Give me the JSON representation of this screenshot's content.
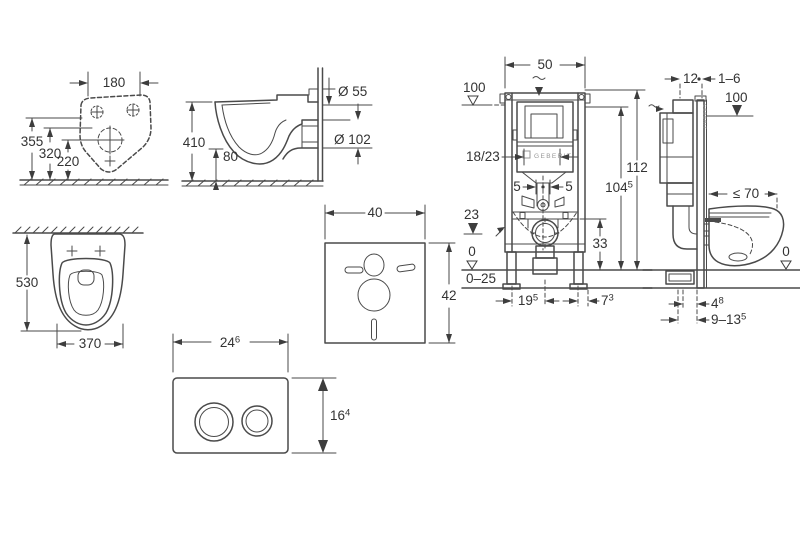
{
  "sheet": {
    "background": "#ffffff",
    "line_color": "#4a4a4a",
    "text_color": "#333333"
  },
  "views": {
    "toilet_rear": {
      "dim_width": "180",
      "dim_h1": "355",
      "dim_h2": "320",
      "dim_h3": "220"
    },
    "toilet_side": {
      "dim_height": "410",
      "dim_outlet_floor": "80",
      "dim_inlet": "Ø 55",
      "dim_outlet": "Ø 102"
    },
    "toilet_top": {
      "dim_depth": "530",
      "dim_width": "370"
    },
    "insulation_pad": {
      "dim_width": "40",
      "dim_height": "42"
    },
    "flush_plate": {
      "dim_width": "24",
      "dim_width_sup": "6",
      "dim_height": "16",
      "dim_height_sup": "4"
    },
    "frame_front": {
      "dim_width": "50",
      "level_top": "100",
      "dim_supply": "18/23",
      "dim_offset_left": "5",
      "dim_offset_right": "5",
      "dim_inlet_height": "23",
      "level_zero": "0",
      "dim_floor_range": "0–25",
      "dim_total_height": "112",
      "dim_height2": "104",
      "dim_height2_sup": "5",
      "dim_outlet_height": "33",
      "dim_leg_spacing": "19",
      "dim_leg_spacing_sup": "5",
      "dim_leg_offset": "7",
      "dim_leg_offset_sup": "3",
      "brand": "GEBERIT"
    },
    "frame_side": {
      "dim_rail_depth": "12",
      "dim_finish": "1–6",
      "level_top": "100",
      "dim_bowl_depth": "≤ 70",
      "level_zero": "0",
      "dim_b1": "4",
      "dim_b1_sup": "8",
      "dim_b2": "9–13",
      "dim_b2_sup": "5",
      "brand": "GEBERIT"
    }
  }
}
